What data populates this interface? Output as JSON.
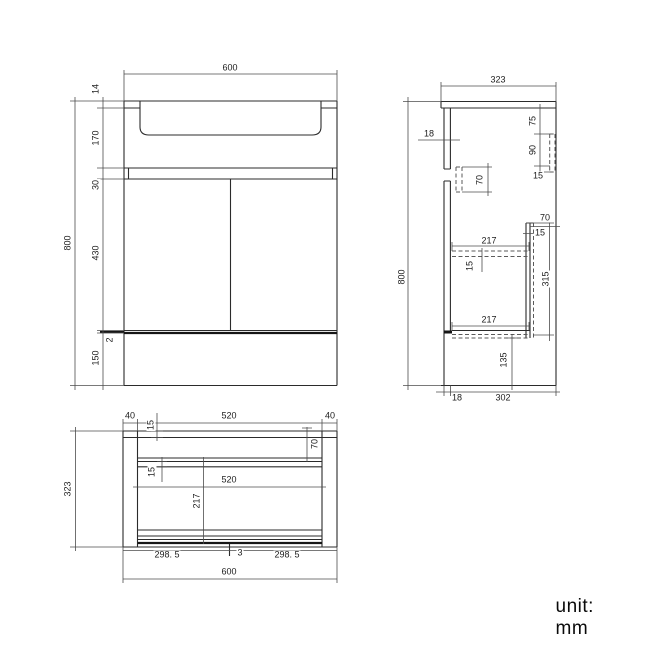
{
  "front_view": {
    "dim_width": "600",
    "dim_height": "800",
    "dim_rim_thickness": "14",
    "dim_basin_depth": "170",
    "dim_top_rail": "30",
    "dim_door_height": "430",
    "dim_gap": "2",
    "dim_base_height": "150"
  },
  "side_view": {
    "dim_width": "323",
    "dim_height": "800",
    "dim_front_thickness": "18",
    "dim_rail_offset": "75",
    "dim_rail_height": "90",
    "dim_rail_thickness": "15",
    "dim_bracket_height": "70",
    "dim_shelf_depth_top": "217",
    "dim_shelf_thickness": "15",
    "dim_back_gap": "70",
    "dim_back_panel_thickness": "15",
    "dim_back_panel_height": "315",
    "dim_shelf_depth_bottom": "217",
    "dim_bottom_height": "135",
    "dim_front_bottom": "18",
    "dim_inner_depth": "302"
  },
  "plan_view": {
    "dim_side_left": "40",
    "dim_inner_width_top": "520",
    "dim_side_right": "40",
    "dim_back_thickness": "15",
    "dim_rail_depth": "70",
    "dim_mid_thickness": "15",
    "dim_inner_width_mid": "520",
    "dim_inner_depth": "217",
    "dim_depth": "323",
    "dim_door_left": "298. 5",
    "dim_center_gap": "3",
    "dim_door_right": "298. 5",
    "dim_width": "600"
  },
  "footer": {
    "unit_label": "unit: mm"
  }
}
